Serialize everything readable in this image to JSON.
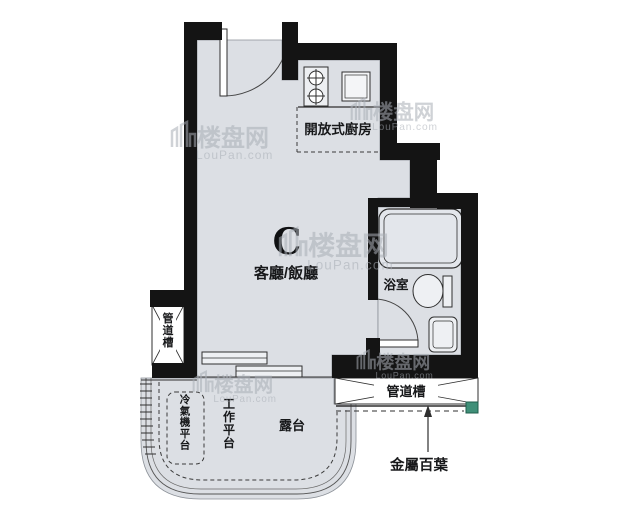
{
  "unit_label": "C",
  "labels": {
    "living_dining": "客廳/飯廳",
    "open_kitchen": "開放式廚房",
    "bathroom": "浴室",
    "balcony": "露台",
    "work_platform": "工作平台",
    "ac_platform": "冷氣機平台",
    "pipe_duct_left": "管道槽",
    "pipe_duct_bottom": "管道槽",
    "metal_louver": "金屬百葉"
  },
  "watermark": {
    "brand": "楼盘网",
    "domain": "LouPan.com"
  },
  "colors": {
    "background": "#ffffff",
    "floor": "#dcdfe4",
    "wall": "#141414",
    "line": "#2f2f2f",
    "louver_cap": "#3f8f78",
    "watermark": "#a9aeb6"
  }
}
